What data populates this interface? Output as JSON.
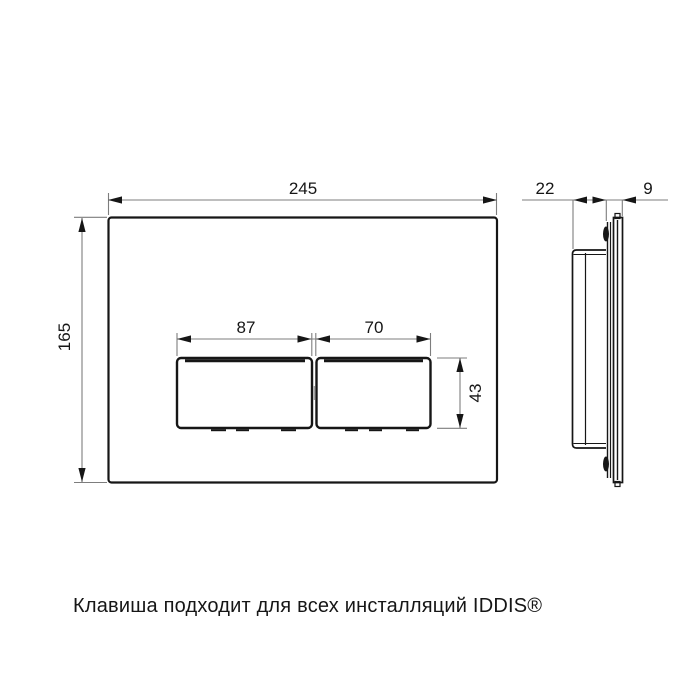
{
  "drawing": {
    "title": "Flush plate technical drawing",
    "front_view": {
      "plate_width_mm": "245",
      "plate_height_mm": "165",
      "left_button_width_mm": "87",
      "right_button_width_mm": "70",
      "button_height_mm": "43"
    },
    "side_view": {
      "depth_mm": "22",
      "plate_thickness_mm": "9"
    }
  },
  "caption": "Клавиша подходит для всех инсталляций IDDIS®",
  "colors": {
    "background": "#ffffff",
    "part_outline": "#161616",
    "dimension_line": "#7d7d7d",
    "text": "#161616"
  }
}
